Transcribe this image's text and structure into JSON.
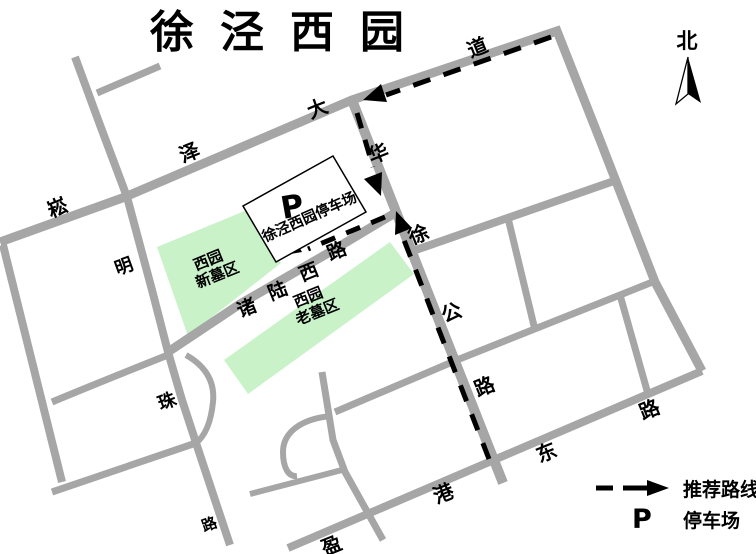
{
  "title": "徐泾西园",
  "compass": {
    "north": "北"
  },
  "road_labels": {
    "songze_dadao": [
      "崧",
      "泽",
      "大",
      "道"
    ],
    "mingzhu_lu": [
      "明",
      "珠",
      "路"
    ],
    "huaxu_gonglu": [
      "华",
      "徐",
      "公",
      "路"
    ],
    "zhulu_xilu": [
      "诸",
      "陆",
      "西",
      "路"
    ],
    "yinggang_donglu": [
      "盈",
      "港",
      "东",
      "路"
    ]
  },
  "areas": {
    "new_cemetery": {
      "line1": "西园",
      "line2": "新墓区"
    },
    "old_cemetery": {
      "line1": "西园",
      "line2": "老墓区"
    }
  },
  "parking": {
    "symbol": "P",
    "name": "徐泾西园停车场"
  },
  "legend": {
    "route": {
      "label": "推荐路线"
    },
    "parking": {
      "symbol": "P",
      "label": "停车场"
    }
  },
  "colors": {
    "road": "#a6a6a6",
    "area_green": "#c9f2c9",
    "route": "#000000"
  }
}
